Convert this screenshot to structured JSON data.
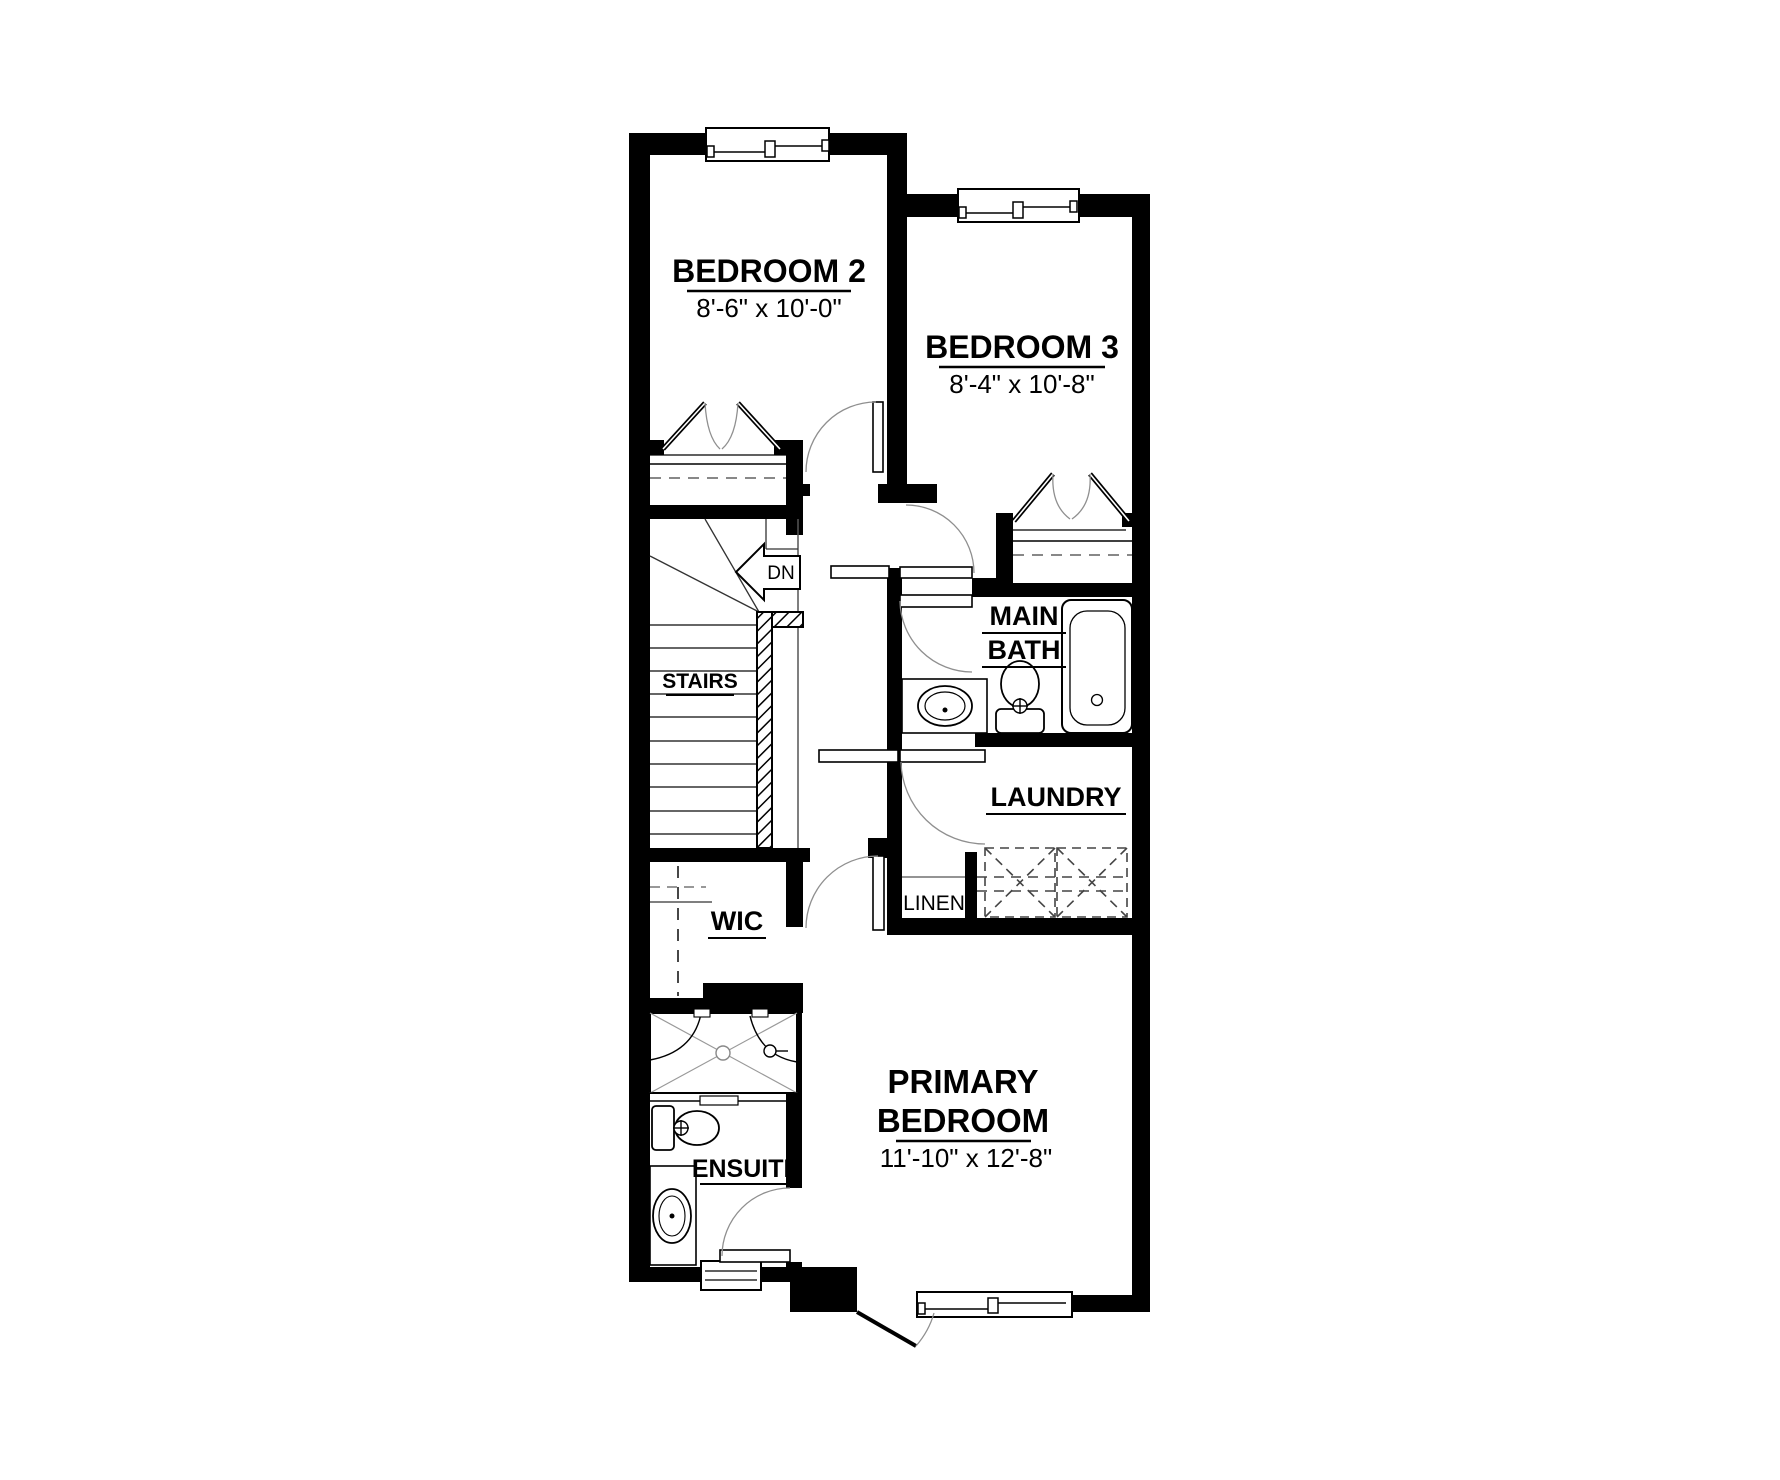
{
  "plan": {
    "type": "residential-floor-plan-upper-level",
    "rooms": {
      "bedroom2": {
        "name": "BEDROOM 2",
        "dims": "8'-6\" x 10'-0\""
      },
      "bedroom3": {
        "name": "BEDROOM 3",
        "dims": "8'-4\" x 10'-8\""
      },
      "main_bath": {
        "line1": "MAIN",
        "line2": "BATH"
      },
      "laundry": {
        "name": "LAUNDRY"
      },
      "linen": {
        "name": "LINEN"
      },
      "wic": {
        "name": "WIC"
      },
      "ensuite": {
        "name": "ENSUITE"
      },
      "stairs": {
        "name": "STAIRS",
        "direction": "DN"
      },
      "primary": {
        "line1": "PRIMARY",
        "line2": "BEDROOM",
        "dims": "11'-10\" x 12'-8\""
      }
    },
    "colors": {
      "walls": "#000000",
      "background": "#ffffff",
      "thin_lines": "#3a3a3a",
      "arc_lines": "#8f8f8f"
    }
  }
}
